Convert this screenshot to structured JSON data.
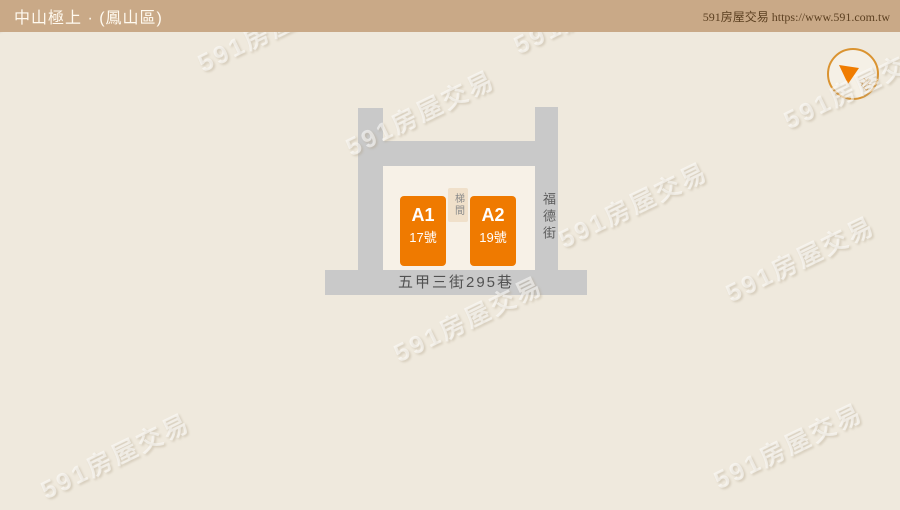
{
  "header": {
    "title": "中山極上 · (鳳山區)",
    "credit": "591房屋交易 https://www.591.com.tw"
  },
  "map": {
    "streets": [
      {
        "name": "福德街",
        "orientation": "vertical"
      },
      {
        "name": "五甲三街295巷",
        "orientation": "horizontal"
      }
    ],
    "buildings": [
      {
        "id": "A1",
        "number": "17號"
      },
      {
        "id": "A2",
        "number": "19號"
      }
    ],
    "stairwell_label": "梯間"
  },
  "compass": {
    "north_label": "北"
  },
  "watermark": {
    "text": "591房屋交易",
    "positions": [
      [
        30,
        4
      ],
      [
        272,
        28
      ],
      [
        588,
        10
      ],
      [
        420,
        112
      ],
      [
        858,
        85
      ],
      [
        633,
        204
      ],
      [
        800,
        258
      ],
      [
        468,
        318
      ],
      [
        115,
        455
      ],
      [
        788,
        445
      ]
    ]
  },
  "colors": {
    "header_bg": "#c9a987",
    "page_bg": "#efe9dd",
    "block_bg": "#f7f1e7",
    "road_gray": "#c9c9c9",
    "building_orange": "#ef7a00",
    "stairwell_bg": "#f0e0ca",
    "compass_ring": "#da9330"
  }
}
